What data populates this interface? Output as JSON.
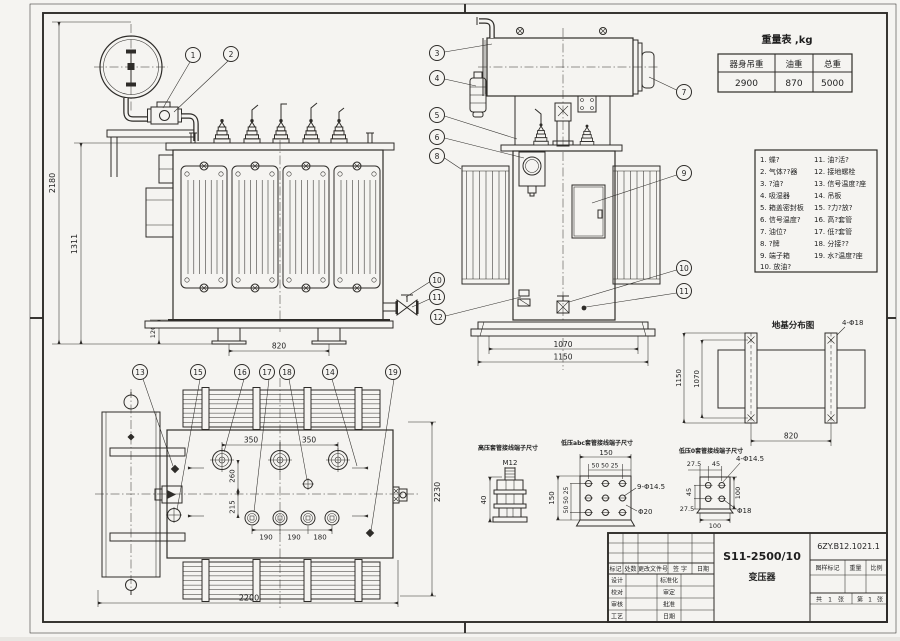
{
  "drawing": {
    "weight_table": {
      "title": "重量表 ,kg",
      "headers": [
        "器身吊重",
        "油重",
        "总重"
      ],
      "values": [
        "2900",
        "870",
        "5000"
      ]
    },
    "parts_list": {
      "col1": [
        "1. 蝶?",
        "2. 气体??器",
        "3. ?油?",
        "4. 吸湿器",
        "5. 箱盖密封板",
        "6. 信号温度?",
        "7. 油位?",
        "8. ?牌",
        "9. 端子箱",
        "10. 放油?"
      ],
      "col2": [
        "11. 油?活?",
        "12. 接地螺栓",
        "13. 信号温度?座",
        "14. 吊板",
        "15. ?力?放?",
        "16. 高?套管",
        "17. 低?套管",
        "18. 分接??",
        "19. 水?温度?座"
      ]
    },
    "callouts": [
      "1",
      "2",
      "3",
      "4",
      "5",
      "6",
      "7",
      "8",
      "9",
      "10",
      "11",
      "12",
      "13",
      "14",
      "15",
      "16",
      "17",
      "18",
      "19"
    ],
    "front_view": {
      "d2180": "2180",
      "d1311": "1311",
      "d120": "120",
      "d820": "820"
    },
    "side_view": {
      "d1070": "1070",
      "d1150": "1150"
    },
    "top_view": {
      "d350a": "350",
      "d350b": "350",
      "d260": "260",
      "d215": "215",
      "d190a": "190",
      "d190b": "190",
      "d180": "180",
      "d2200": "2200",
      "d2230": "2230"
    },
    "foundation": {
      "title": "地基分布图",
      "bolts": "4-Φ18",
      "d1150": "1150",
      "d1070": "1070",
      "d820": "820"
    },
    "hv_detail": {
      "label": "高压套管接线端子尺寸",
      "thread": "M12",
      "d40": "40"
    },
    "lv_abc_detail": {
      "label": "低压abc套管接线端子尺寸",
      "d150t": "150",
      "dsubt": "50 50 25",
      "d150l": "150",
      "dsubl": "50 50 25",
      "holes": "9-Φ14.5",
      "boss": "Φ20"
    },
    "lv_o_detail": {
      "label": "低压0套管接线端子尺寸",
      "d275t": "27.5",
      "d45t": "45",
      "d45l": "45",
      "d275l": "27.5",
      "d100r": "100",
      "d100b": "100",
      "holes": "4-Φ14.5",
      "d18": "Φ18"
    },
    "title_block": {
      "model": "S11-2500/10",
      "name": "变压器",
      "drawing_no": "6ZY.B12.1021.1",
      "cols": [
        "标记",
        "处数",
        "更改文件号",
        "签 字",
        "日期"
      ],
      "left_rows": [
        "设计",
        "校对",
        "审核",
        "工艺"
      ],
      "right_rows": [
        "标准化",
        "审定",
        "批准",
        "日期"
      ],
      "stamp": [
        "图样标记",
        "重量",
        "比例"
      ],
      "sheet": [
        "共",
        "1",
        "张",
        "第",
        "1",
        "张"
      ]
    }
  }
}
